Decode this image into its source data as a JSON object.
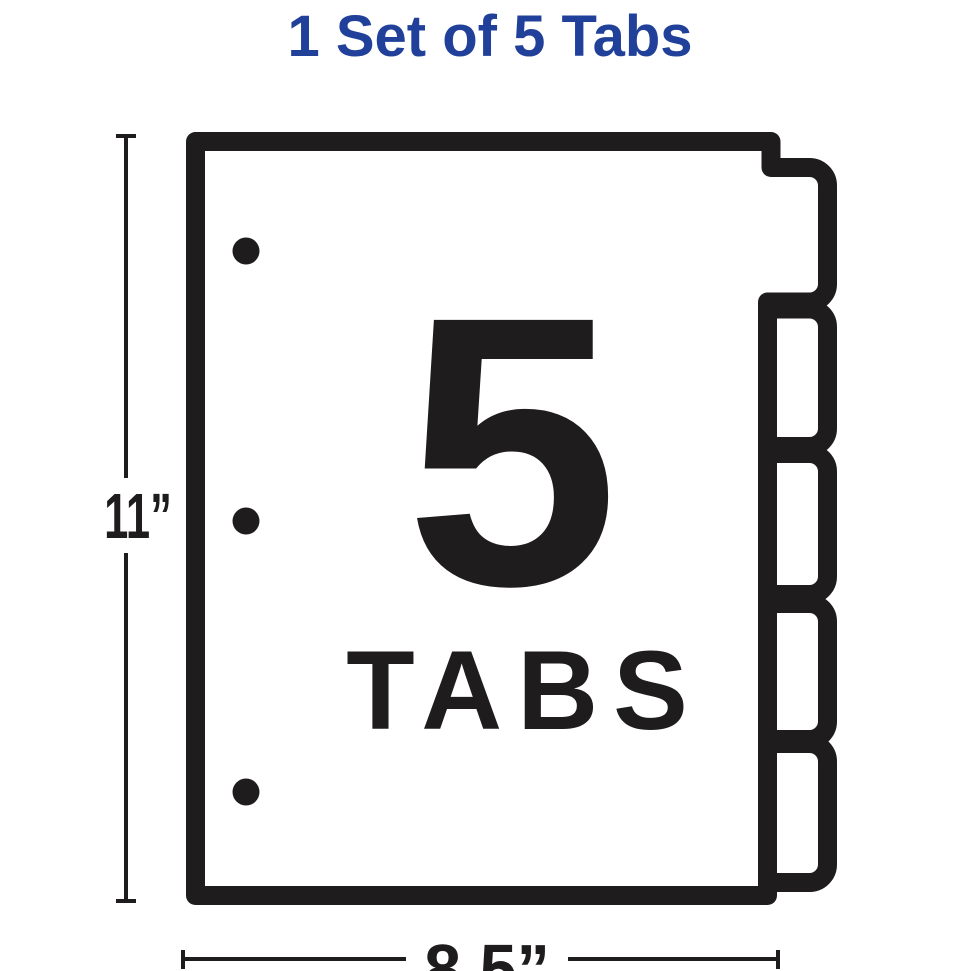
{
  "title": {
    "text": "1 Set of 5 Tabs",
    "color": "#21409a"
  },
  "illustration": {
    "type": "binder-divider-sheet",
    "tab_count": 5,
    "hole_punch_count": 3,
    "center_label": {
      "count": "5",
      "word": "TABS"
    },
    "line_color": "#1e1c1c",
    "paper_color": "#ffffff"
  },
  "dimensions": {
    "height_label": "11”",
    "width_label": "8.5”"
  }
}
